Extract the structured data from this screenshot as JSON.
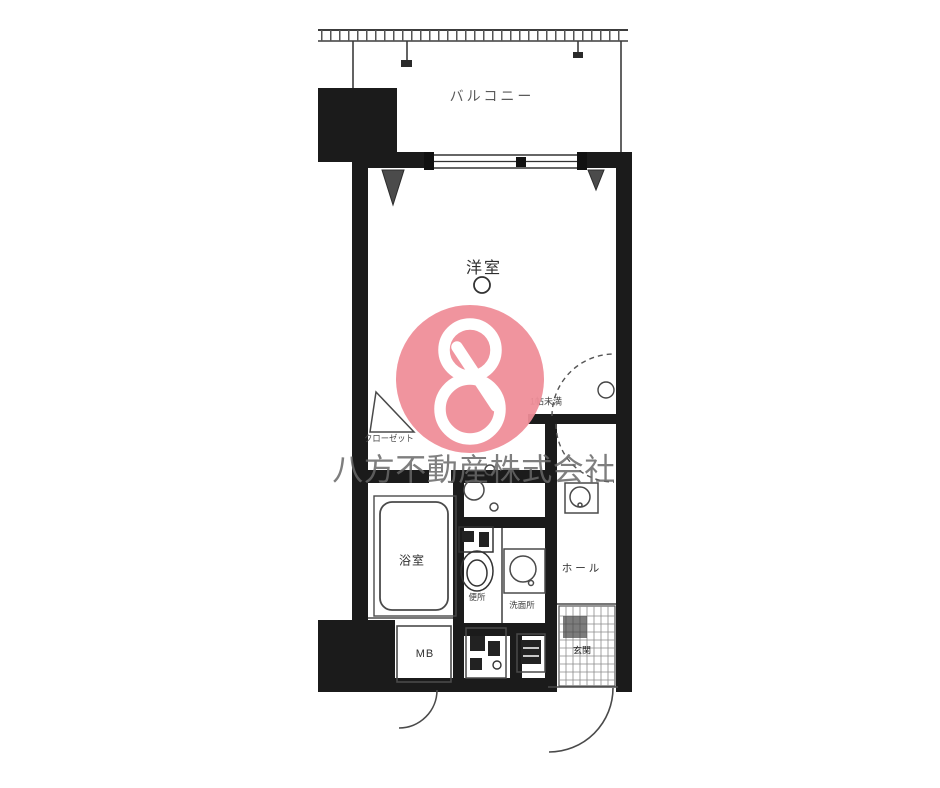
{
  "rooms": {
    "balcony": "バルコニー",
    "western_room": "洋室",
    "closet": "クローゼット",
    "size_note": "1帖未満",
    "bath": "浴室",
    "toilet": "便所",
    "washroom": "洗面所",
    "hall": "ホール",
    "entrance": "玄関",
    "meter_box": "MB"
  },
  "watermark": {
    "company": "八方不動産株式会社",
    "logo_symbol": "8",
    "logo_color": "#ef8d98",
    "text_color": "#676767"
  },
  "colors": {
    "wall": "#1b1b1b",
    "line": "#4a4a4a"
  }
}
